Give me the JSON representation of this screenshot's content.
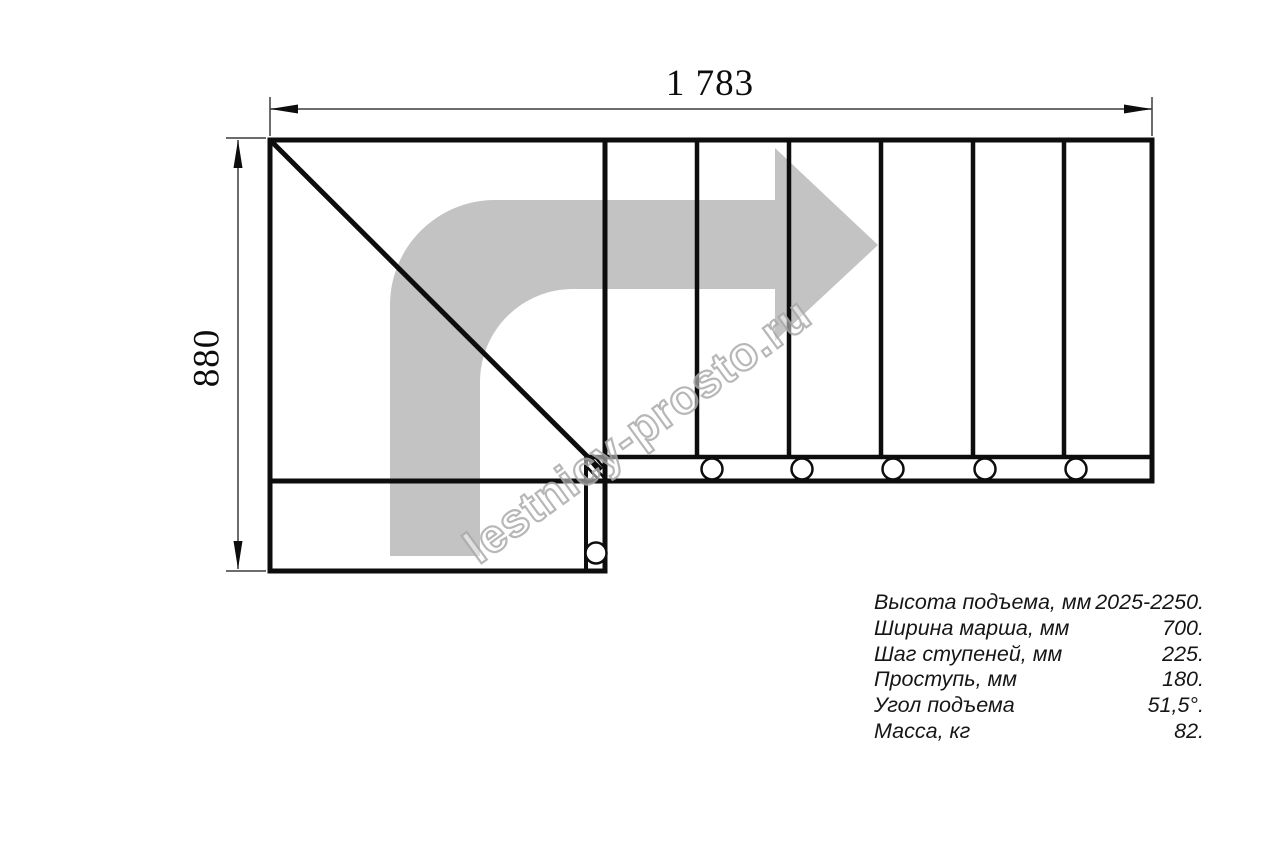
{
  "dimensions": {
    "width_label": "1 783",
    "height_label": "880"
  },
  "watermark": {
    "text": "lestnicy-prosto.ru"
  },
  "specs": {
    "rows": [
      {
        "label": "Высота подъема, мм",
        "value": "2025-2250."
      },
      {
        "label": "Ширина марша, мм",
        "value": "700."
      },
      {
        "label": "Шаг ступеней, мм",
        "value": "225."
      },
      {
        "label": "Проступь, мм",
        "value": "180."
      },
      {
        "label": "Угол подъема",
        "value": "51,5°."
      },
      {
        "label": "Масса, кг",
        "value": "82."
      }
    ]
  },
  "icons": {
    "direction_arrow": "turn-right-arrow",
    "fastener": "bolt-circle",
    "corner_joint": "hatched-joint-marker"
  },
  "colors": {
    "line-black": "#0d0d0d",
    "dimension-gray": "#3c3c3c",
    "arrow-gray": "#c3c3c3",
    "watermark-gray": "#ababab",
    "spec-text": "#161616",
    "background": "#ffffff"
  }
}
